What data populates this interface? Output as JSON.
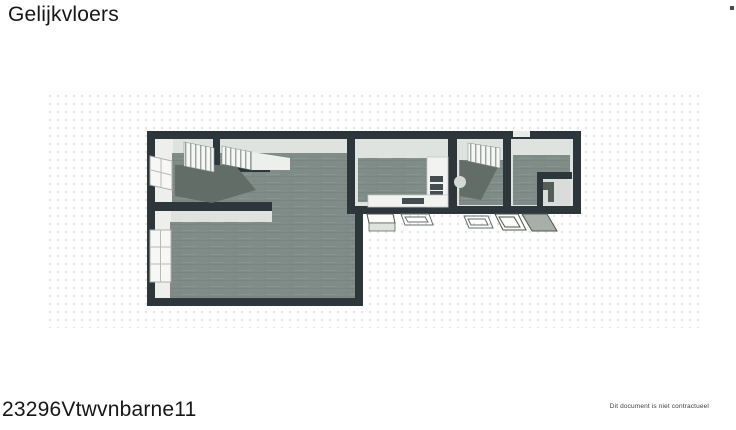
{
  "header": {
    "title": "Gelijkvloers"
  },
  "footer": {
    "reference": "23296Vtwvnbarne11",
    "disclaimer": "Dit document is niet contractueel"
  },
  "colors": {
    "wall": "#2d363a",
    "wall_face": "#dfe3df",
    "wall_face_bright": "#edefec",
    "floor": "#7f8c87",
    "floor_line": "#73807b",
    "floor_small_room": "#d9dcd9",
    "stair_tread": "#626d68",
    "grid_dot": "#e2e2e2",
    "text": "#161616"
  }
}
